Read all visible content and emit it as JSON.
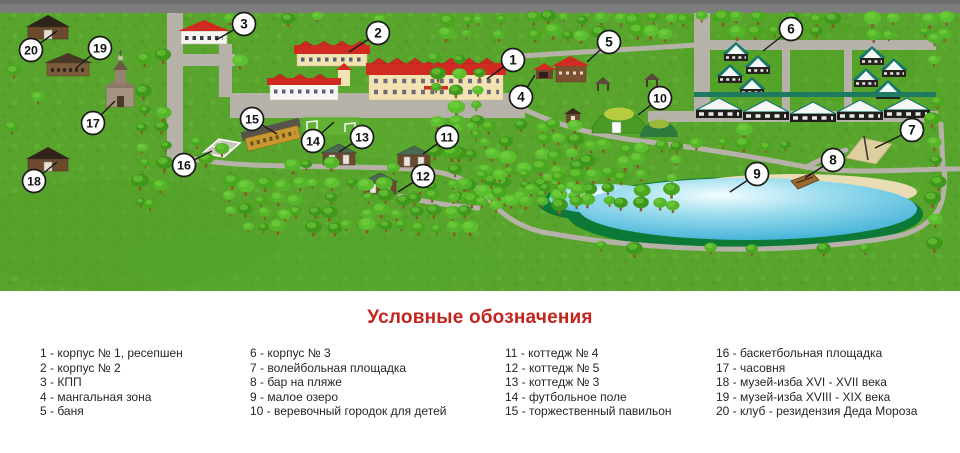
{
  "legend": {
    "title": "Условные обозначения",
    "items": [
      {
        "n": "1",
        "label": "корпус № 1, ресепшен"
      },
      {
        "n": "2",
        "label": "корпус № 2"
      },
      {
        "n": "3",
        "label": "КПП"
      },
      {
        "n": "4",
        "label": "мангальная зона"
      },
      {
        "n": "5",
        "label": "баня"
      },
      {
        "n": "6",
        "label": "корпус № 3"
      },
      {
        "n": "7",
        "label": "волейбольная площадка"
      },
      {
        "n": "8",
        "label": "бар на пляже"
      },
      {
        "n": "9",
        "label": "малое озеро"
      },
      {
        "n": "10",
        "label": "веревочный городок для детей"
      },
      {
        "n": "11",
        "label": "коттедж № 4"
      },
      {
        "n": "12",
        "label": "коттедж № 5"
      },
      {
        "n": "13",
        "label": "коттедж № 3"
      },
      {
        "n": "14",
        "label": "футбольное поле"
      },
      {
        "n": "15",
        "label": "торжественный павильон"
      },
      {
        "n": "16",
        "label": "баскетбольная площадка"
      },
      {
        "n": "17",
        "label": "часовня"
      },
      {
        "n": "18",
        "label": "музей-изба XVI - XVII века"
      },
      {
        "n": "19",
        "label": "музей-изба XVIII - XIX века"
      },
      {
        "n": "20",
        "label": "клуб - резидензия Деда Мороза"
      }
    ]
  },
  "map": {
    "markers": [
      {
        "n": "1",
        "x": 513,
        "y": 60,
        "lx": 487,
        "ly": 79
      },
      {
        "n": "2",
        "x": 378,
        "y": 33,
        "lx": 349,
        "ly": 52
      },
      {
        "n": "3",
        "x": 244,
        "y": 24,
        "lx": 216,
        "ly": 40
      },
      {
        "n": "4",
        "x": 521,
        "y": 97,
        "lx": 535,
        "ly": 75
      },
      {
        "n": "5",
        "x": 609,
        "y": 42,
        "lx": 587,
        "ly": 62
      },
      {
        "n": "6",
        "x": 791,
        "y": 29,
        "lx": 763,
        "ly": 51
      },
      {
        "n": "7",
        "x": 912,
        "y": 130,
        "lx": 875,
        "ly": 148
      },
      {
        "n": "8",
        "x": 833,
        "y": 160,
        "lx": 805,
        "ly": 178
      },
      {
        "n": "9",
        "x": 757,
        "y": 174,
        "lx": 730,
        "ly": 192
      },
      {
        "n": "10",
        "x": 660,
        "y": 98,
        "lx": 638,
        "ly": 115
      },
      {
        "n": "11",
        "x": 447,
        "y": 137,
        "lx": 423,
        "ly": 154
      },
      {
        "n": "12",
        "x": 423,
        "y": 176,
        "lx": 398,
        "ly": 192
      },
      {
        "n": "13",
        "x": 362,
        "y": 137,
        "lx": 339,
        "ly": 152
      },
      {
        "n": "14",
        "x": 313,
        "y": 141,
        "lx": 334,
        "ly": 122
      },
      {
        "n": "15",
        "x": 252,
        "y": 119,
        "lx": 277,
        "ly": 134
      },
      {
        "n": "16",
        "x": 184,
        "y": 165,
        "lx": 212,
        "ly": 151
      },
      {
        "n": "17",
        "x": 93,
        "y": 123,
        "lx": 115,
        "ly": 101
      },
      {
        "n": "18",
        "x": 34,
        "y": 181,
        "lx": 57,
        "ly": 162
      },
      {
        "n": "19",
        "x": 100,
        "y": 48,
        "lx": 76,
        "ly": 68
      },
      {
        "n": "20",
        "x": 31,
        "y": 50,
        "lx": 57,
        "ly": 31
      }
    ],
    "colors": {
      "grass": "#58a42c",
      "road": "#b6b2aa",
      "top_road": "#7d7d7d",
      "roof_red": "#cf2b20",
      "lake_blue": "#2fa9d4",
      "shore_green": "#0c7a36",
      "sand": "#e8ddb4",
      "teal": "#17776b",
      "accent_red": "#c3241e"
    }
  }
}
